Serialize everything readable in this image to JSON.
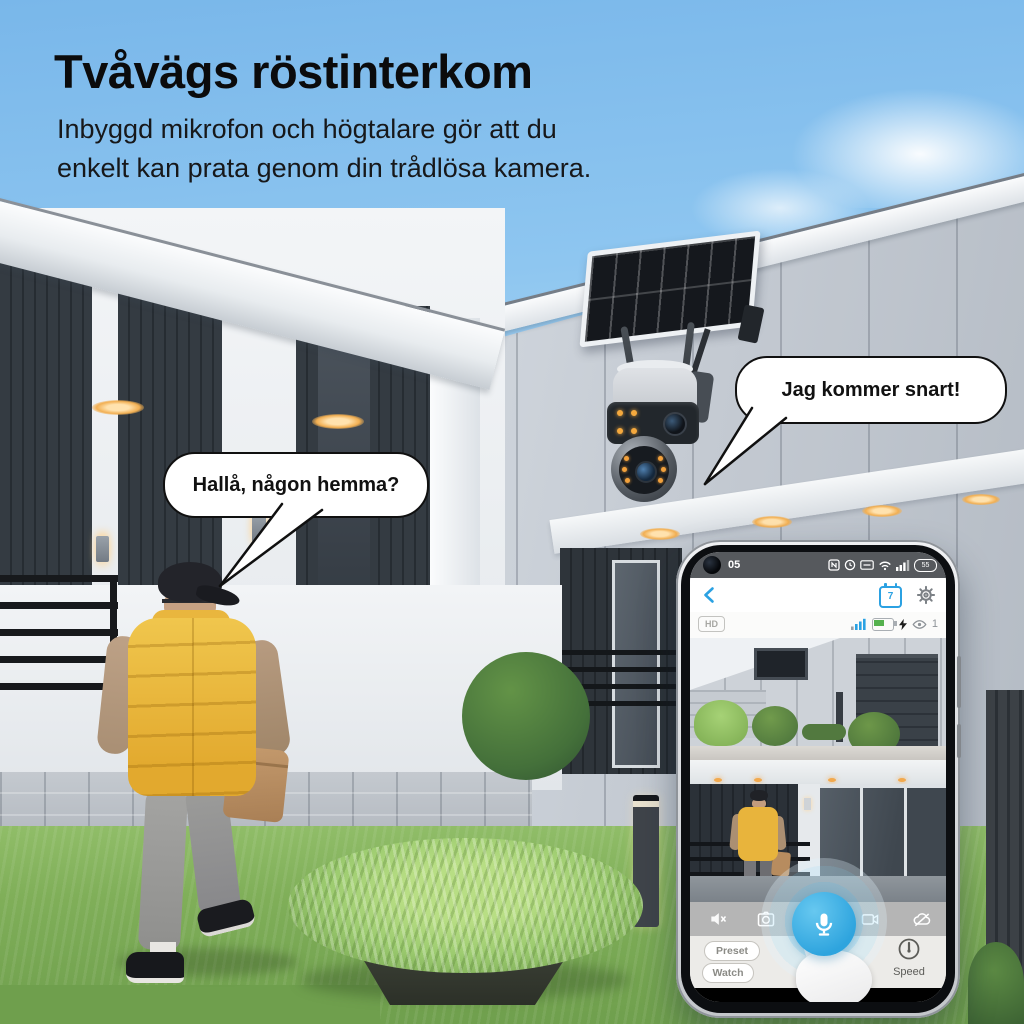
{
  "page": {
    "title": "Tvåvägs röstinterkom",
    "subtitle_line1": "Inbyggd mikrofon och högtalare gör att du",
    "subtitle_line2": "enkelt kan prata genom din trådlösa kamera."
  },
  "speech": {
    "camera_bubble": "Jag kommer snart!",
    "visitor_bubble": "Hallå, någon hemma?"
  },
  "phone": {
    "status_bar": {
      "time": "05",
      "battery": "55"
    },
    "nav_bar": {
      "calendar_day": "7"
    },
    "stream_bar": {
      "quality": "HD",
      "viewers": "1"
    },
    "toolbar_icons": [
      "speaker-mute",
      "snapshot",
      "microphone",
      "record",
      "cloud-off"
    ],
    "controls": {
      "preset": "Preset",
      "watch": "Watch",
      "speed": "Speed"
    }
  },
  "colors": {
    "accent_blue": "#2ea4de",
    "battery_green": "#55b14e",
    "vest_yellow": "#e8b43c",
    "title_text": "#0b0b0c"
  }
}
